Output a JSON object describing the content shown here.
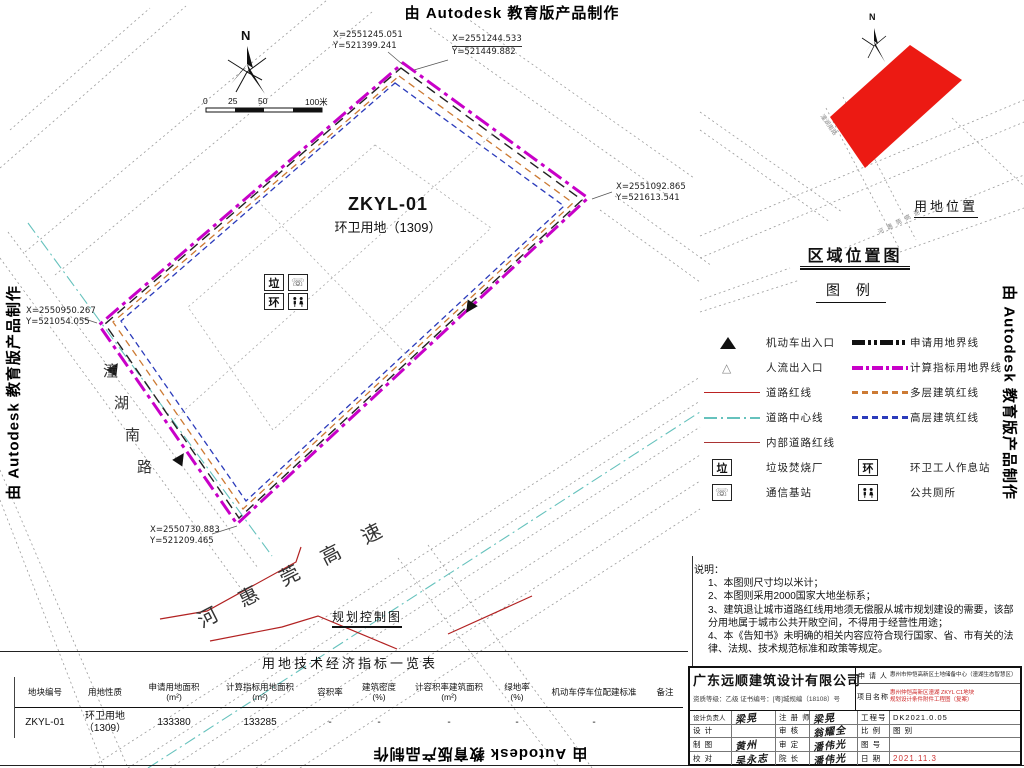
{
  "watermark": {
    "text": "由 Autodesk 教育版产品制作"
  },
  "north_label": "N",
  "scale_bar": {
    "ticks": [
      "0",
      "25",
      "50",
      "100米"
    ]
  },
  "site": {
    "code": "ZKYL-01",
    "use": "环卫用地（1309）"
  },
  "coords": {
    "top_a": {
      "x": "X=2551245.051",
      "y": "Y=521399.241"
    },
    "top_b": {
      "x": "X=2551244.533",
      "y": "Y=521449.882"
    },
    "east": {
      "x": "X=2551092.865",
      "y": "Y=521613.541"
    },
    "west": {
      "x": "X=2550950.267",
      "y": "Y=521054.055"
    },
    "south": {
      "x": "X=2550730.883",
      "y": "Y=521209.465"
    }
  },
  "roads": {
    "south_road": "潼湖南路",
    "south_road_chars": [
      "潼",
      "湖",
      "南",
      "路"
    ],
    "highway": "河惠莞高速",
    "plan_label": "规划控制图"
  },
  "map_icons": {
    "la": "垃",
    "huan": "环",
    "phone": "☏"
  },
  "inset": {
    "title": "区域位置图",
    "location_label": "用地位置",
    "north_label": "N"
  },
  "legend": {
    "title": "图 例",
    "left": [
      {
        "icon": "vehicle-entrance-triangle",
        "label": "机动车出入口"
      },
      {
        "icon": "pedestrian-entrance-triangle",
        "label": "人流出入口"
      },
      {
        "icon": "road-red-line",
        "label": "道路红线"
      },
      {
        "icon": "road-center-line",
        "label": "道路中心线"
      },
      {
        "icon": "internal-road-red-line",
        "label": "内部道路红线"
      },
      {
        "icon": "garbage-station-box",
        "glyph": "垃",
        "label": "垃圾焚烧厂"
      },
      {
        "icon": "telecom-station-box",
        "glyph": "☏",
        "label": "通信基站"
      }
    ],
    "right": [
      {
        "icon": "applied-land-boundary",
        "label": "申请用地界线"
      },
      {
        "icon": "indicator-land-boundary",
        "label": "计算指标用地界线"
      },
      {
        "icon": "multistorey-building-red-line",
        "label": "多层建筑红线"
      },
      {
        "icon": "highrise-building-red-line",
        "label": "高层建筑红线"
      },
      {
        "icon": "sanitation-rest-station-box",
        "glyph": "环",
        "label": "环卫工人作息站"
      },
      {
        "icon": "public-toilet-box",
        "label": "公共厕所"
      }
    ]
  },
  "notes": {
    "title": "说明：",
    "items": [
      "1、本图则尺寸均以米计；",
      "2、本图则采用2000国家大地坐标系；",
      "3、建筑退让城市道路红线用地须无偿服从城市规划建设的需要，该部分用地属于城市公共开敞空间，不得用于经营性用途；",
      "4、本《告知书》未明确的相关内容应符合现行国家、省、市有关的法律、法规、技术规范标准和政策等规定。"
    ]
  },
  "table": {
    "title": "用地技术经济指标一览表",
    "headers": [
      "地块编号",
      "用地性质",
      "申请用地面积\n(m²)",
      "计算指标用地面积\n(m²)",
      "容积率",
      "建筑密度\n(%)",
      "计容积率建筑面积\n(m²)",
      "绿地率\n(%)",
      "机动车停车位配建标准",
      "备注"
    ],
    "row": [
      "ZKYL-01",
      "环卫用地\n（1309）",
      "133380",
      "133285",
      "-",
      "-",
      "-",
      "-",
      "-",
      ""
    ]
  },
  "titleblock": {
    "company": "广东远顺建筑设计有限公司",
    "credentials": "资质等级：乙级  证书编号：[粤]城规编（18108）号",
    "applicant_label": "申 请 人",
    "applicant": "惠州市仲恺高新区土地储备中心（潼湖生态智慧区）",
    "project_label": "项目名称",
    "project_line1": "惠州仲恺高新区潼湖 ZKYL C1地块",
    "project_line2": "规划设计条件附件工程图（复案）",
    "fields": {
      "lead_label": "设计负责人",
      "lead": "梁晃",
      "registered_label": "注 册 师",
      "registered": "梁晃",
      "design_label": "设  计",
      "design": "",
      "check_label": "审  核",
      "check": "翁耀全",
      "draft_label": "制  图",
      "draft": "黄州",
      "approve_label": "审  定",
      "approve": "潘伟光",
      "proof_label": "校  对",
      "proof": "吴永志",
      "dean_label": "院  长",
      "dean": "潘伟光",
      "projno_label": "工程号",
      "projno": "DK2021.0.05",
      "scale_label": "比  例",
      "sheet_label": "图  别",
      "figno_label": "图  号",
      "figno": "",
      "date_label": "日  期",
      "date": "2021.11.3"
    }
  }
}
